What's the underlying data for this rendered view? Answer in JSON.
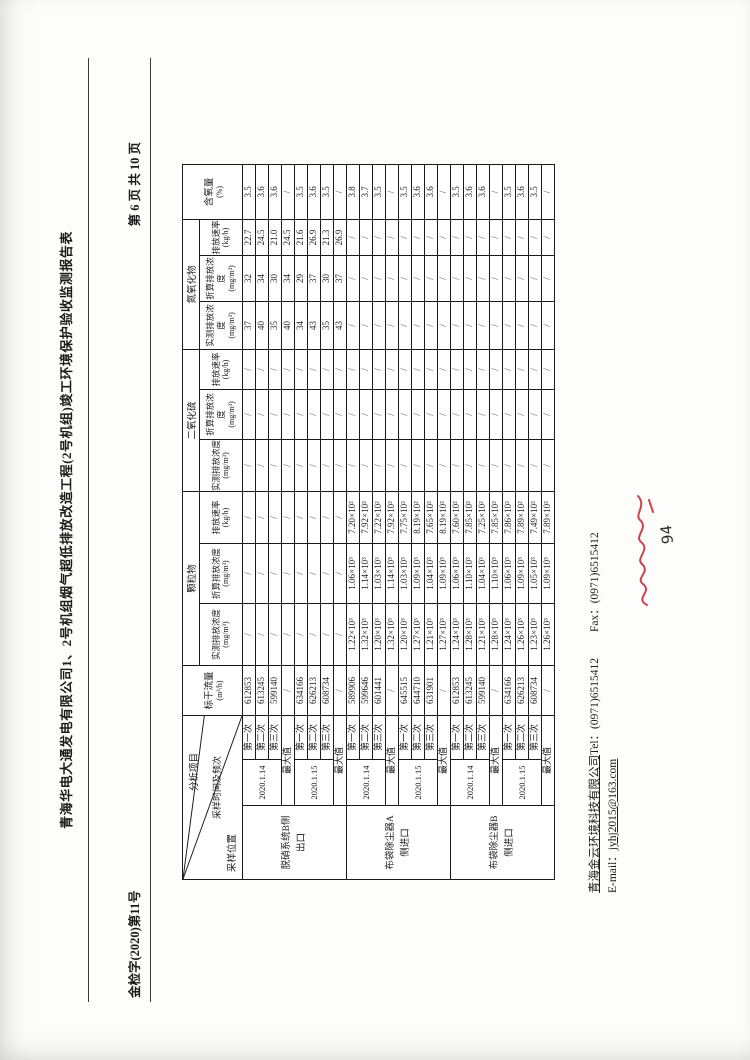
{
  "header": {
    "doc_number": "金检字(2020)第11号",
    "page_info": "第 6 页 共 10 页",
    "title": "青海华电大通发电有限公司1、2号机组烟气超低排放改造工程(2号机组)竣工环境保护验收监测报告表"
  },
  "table": {
    "header": {
      "diagonal": {
        "top": "分析项目",
        "middle": "采样时间及频次",
        "bottom": "采样位置"
      },
      "flow": {
        "label": "标干流量",
        "unit": "(m³/h)"
      },
      "groups": [
        "颗粒物",
        "二氧化硫",
        "氮氧化物"
      ],
      "sub": [
        {
          "label": "实测排放浓度",
          "unit": "(mg/m³)"
        },
        {
          "label": "折算排放浓度",
          "unit": "(mg/m³)"
        },
        {
          "label": "排放速率",
          "unit": "(kg/h)"
        }
      ],
      "oxygen": {
        "label": "含氧量",
        "unit": "(%)"
      }
    },
    "groups": [
      {
        "location": "脱硝系统B侧出口",
        "blocks": [
          {
            "date": "2020.1.14",
            "rows": [
              [
                "第一次",
                "612853",
                "/",
                "/",
                "/",
                "/",
                "/",
                "/",
                "37",
                "32",
                "22.7",
                "3.5"
              ],
              [
                "第二次",
                "613245",
                "/",
                "/",
                "/",
                "/",
                "/",
                "/",
                "40",
                "34",
                "24.5",
                "3.6"
              ],
              [
                "第三次",
                "599140",
                "/",
                "/",
                "/",
                "/",
                "/",
                "/",
                "35",
                "30",
                "21.0",
                "3.6"
              ]
            ],
            "max": [
              "最大值",
              "/",
              "/",
              "/",
              "/",
              "/",
              "/",
              "/",
              "40",
              "34",
              "24.5",
              "/"
            ]
          },
          {
            "date": "2020.1.15",
            "rows": [
              [
                "第一次",
                "634166",
                "/",
                "/",
                "/",
                "/",
                "/",
                "/",
                "34",
                "29",
                "21.6",
                "3.5"
              ],
              [
                "第二次",
                "626213",
                "/",
                "/",
                "/",
                "/",
                "/",
                "/",
                "43",
                "37",
                "26.9",
                "3.6"
              ],
              [
                "第三次",
                "608734",
                "/",
                "/",
                "/",
                "/",
                "/",
                "/",
                "35",
                "30",
                "21.3",
                "3.5"
              ]
            ],
            "max": [
              "最大值",
              "/",
              "/",
              "/",
              "/",
              "/",
              "/",
              "/",
              "43",
              "37",
              "26.9",
              "/"
            ]
          }
        ]
      },
      {
        "location": "布袋除尘器A侧进口",
        "blocks": [
          {
            "date": "2020.1.14",
            "rows": [
              [
                "第一次",
                "589906",
                "1.22×10³",
                "1.06×10³",
                "7.20×10²",
                "/",
                "/",
                "/",
                "/",
                "/",
                "/",
                "3.8"
              ],
              [
                "第二次",
                "599646",
                "1.32×10³",
                "1.14×10³",
                "7.92×10²",
                "/",
                "/",
                "/",
                "/",
                "/",
                "/",
                "3.7"
              ],
              [
                "第三次",
                "601441",
                "1.20×10³",
                "1.03×10³",
                "7.22×10²",
                "/",
                "/",
                "/",
                "/",
                "/",
                "/",
                "3.5"
              ]
            ],
            "max": [
              "最大值",
              "/",
              "1.32×10³",
              "1.14×10³",
              "7.92×10²",
              "/",
              "/",
              "/",
              "/",
              "/",
              "/",
              "/"
            ]
          },
          {
            "date": "2020.1.15",
            "rows": [
              [
                "第一次",
                "645515",
                "1.20×10³",
                "1.03×10³",
                "7.75×10²",
                "/",
                "/",
                "/",
                "/",
                "/",
                "/",
                "3.5"
              ],
              [
                "第二次",
                "644710",
                "1.27×10³",
                "1.09×10³",
                "8.19×10²",
                "/",
                "/",
                "/",
                "/",
                "/",
                "/",
                "3.6"
              ],
              [
                "第三次",
                "631901",
                "1.21×10³",
                "1.04×10³",
                "7.65×10²",
                "/",
                "/",
                "/",
                "/",
                "/",
                "/",
                "3.6"
              ]
            ],
            "max": [
              "最大值",
              "/",
              "1.27×10³",
              "1.09×10³",
              "8.19×10²",
              "/",
              "/",
              "/",
              "/",
              "/",
              "/",
              "/"
            ]
          }
        ]
      },
      {
        "location": "布袋除尘器B侧进口",
        "blocks": [
          {
            "date": "2020.1.14",
            "rows": [
              [
                "第一次",
                "612853",
                "1.24×10³",
                "1.06×10³",
                "7.60×10²",
                "/",
                "/",
                "/",
                "/",
                "/",
                "/",
                "3.5"
              ],
              [
                "第二次",
                "613245",
                "1.28×10³",
                "1.10×10³",
                "7.85×10²",
                "/",
                "/",
                "/",
                "/",
                "/",
                "/",
                "3.6"
              ],
              [
                "第三次",
                "599140",
                "1.21×10³",
                "1.04×10³",
                "7.25×10²",
                "/",
                "/",
                "/",
                "/",
                "/",
                "/",
                "3.6"
              ]
            ],
            "max": [
              "最大值",
              "/",
              "1.28×10³",
              "1.10×10³",
              "7.85×10²",
              "/",
              "/",
              "/",
              "/",
              "/",
              "/",
              "/"
            ]
          },
          {
            "date": "2020.1.15",
            "rows": [
              [
                "第一次",
                "634166",
                "1.24×10³",
                "1.06×10³",
                "7.86×10²",
                "/",
                "/",
                "/",
                "/",
                "/",
                "/",
                "3.5"
              ],
              [
                "第二次",
                "626213",
                "1.26×10³",
                "1.09×10³",
                "7.89×10²",
                "/",
                "/",
                "/",
                "/",
                "/",
                "/",
                "3.6"
              ],
              [
                "第三次",
                "608734",
                "1.23×10³",
                "1.05×10³",
                "7.49×10²",
                "/",
                "/",
                "/",
                "/",
                "/",
                "/",
                "3.5"
              ]
            ],
            "max": [
              "最大值",
              "/",
              "1.26×10³",
              "1.09×10³",
              "7.89×10²",
              "/",
              "/",
              "/",
              "/",
              "/",
              "/",
              "/"
            ]
          }
        ]
      }
    ]
  },
  "footer": {
    "company": "青海金云环境科技有限公司",
    "tel_label": "Tel：",
    "tel": "(0971)6515412",
    "fax_label": "Fax：",
    "fax": "(0971)6515412",
    "email_label": "E-mail：",
    "email": "jyhj2015@163.com",
    "handwritten_page_number": "94"
  }
}
